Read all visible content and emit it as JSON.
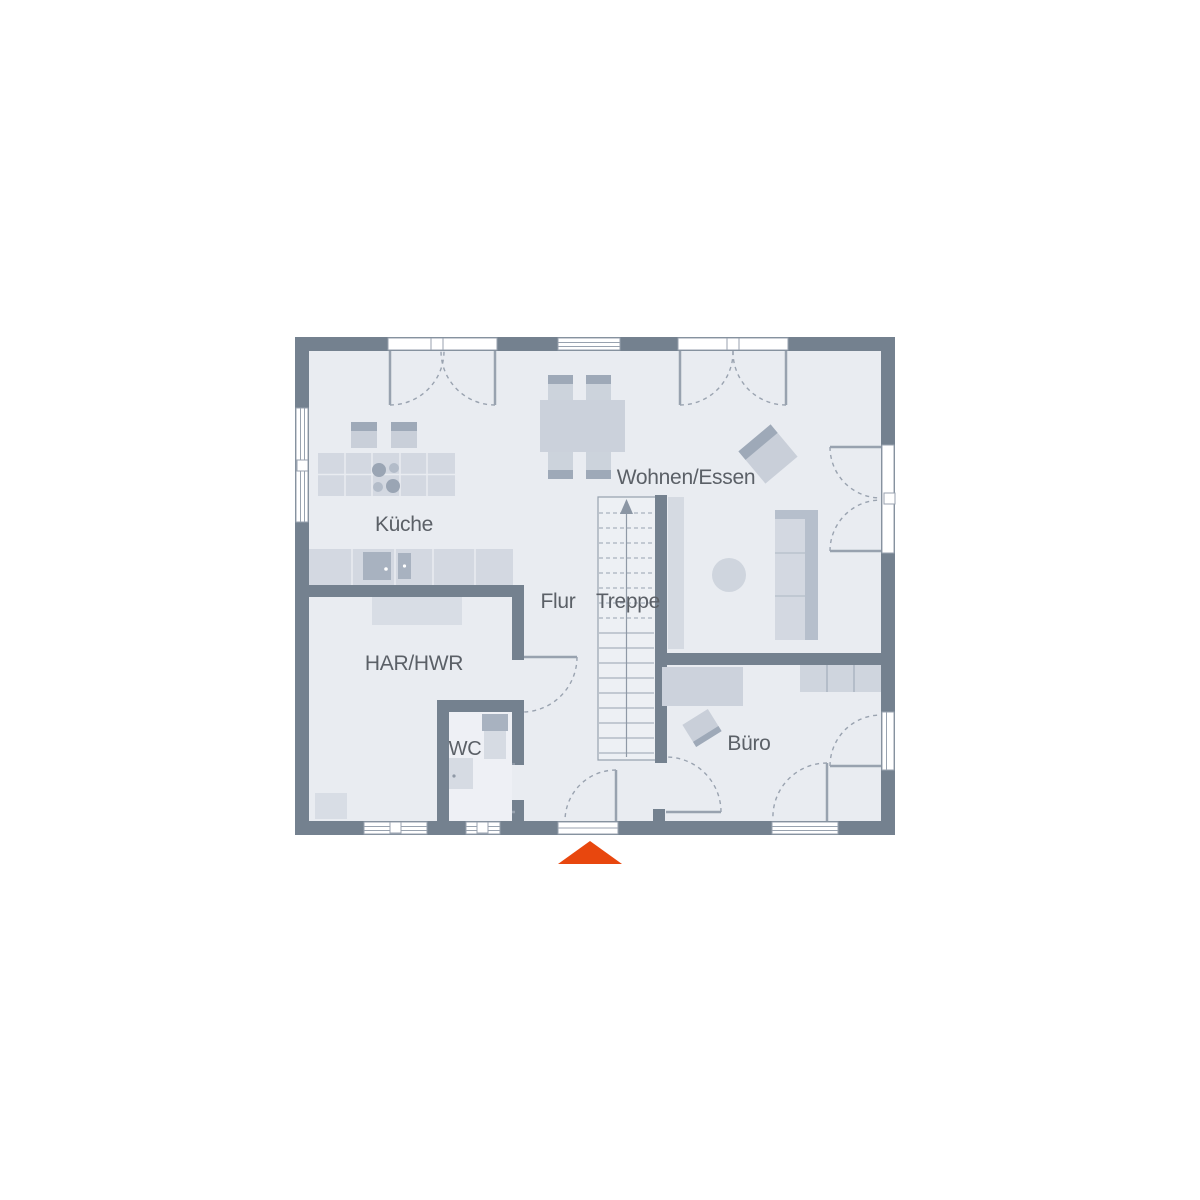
{
  "plan": {
    "rooms": {
      "kueche": "Küche",
      "wohnen_essen": "Wohnen/Essen",
      "flur": "Flur",
      "treppe": "Treppe",
      "har_hwr": "HAR/HWR",
      "wc": "WC",
      "buero": "Büro"
    },
    "colors": {
      "wall": "#74818f",
      "floor": "#e9ecf1",
      "stair_floor": "#edf0f4",
      "furniture_light": "#d3d8e1",
      "furniture_mid": "#c9cfd9",
      "furniture_dark": "#9ea9b8",
      "fixture_dark": "#a8b2c0",
      "line": "#98a2af",
      "label_text": "#5b6067",
      "entrance_marker": "#e8470e"
    },
    "markers": {
      "entrance_icon": "triangle-up",
      "stair_direction_icon": "arrow-up"
    }
  }
}
